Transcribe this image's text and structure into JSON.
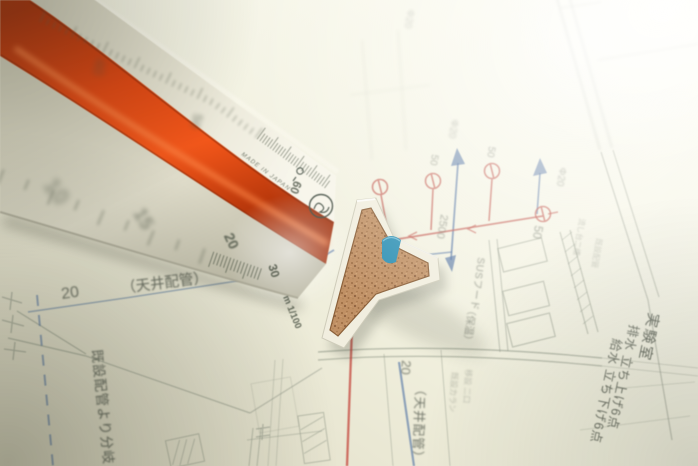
{
  "ruler": {
    "made_in_label": "MADE IN JAPAN",
    "scale_label": "m 1/100",
    "near_face_numbers": [
      "10",
      "15",
      "20",
      "30"
    ],
    "top_face_numbers": [
      "40",
      "50",
      "60"
    ]
  },
  "drawing": {
    "labels": [
      {
        "id": "dim-20-left",
        "text": "20"
      },
      {
        "id": "ceiling-pipe-h",
        "text": "（天井配管）"
      },
      {
        "id": "branch-note",
        "text": "既設配管より分岐"
      },
      {
        "id": "room-lab",
        "text": "実験室"
      },
      {
        "id": "drain-note",
        "text": "排水 立ち上げ6点"
      },
      {
        "id": "supply-note",
        "text": "給水 立ち下げ6点"
      },
      {
        "id": "ceiling-pipe-v",
        "text": "（天井配管）"
      },
      {
        "id": "small-note-1",
        "text": "既設カラン"
      },
      {
        "id": "small-note-2",
        "text": "移設 二口"
      },
      {
        "id": "sus-hood",
        "text": "SUSフード"
      },
      {
        "id": "hood-sub",
        "text": "（保温）"
      },
      {
        "id": "dim-2500",
        "text": "2500"
      },
      {
        "id": "dim-50-a",
        "text": "50"
      },
      {
        "id": "dim-50-b",
        "text": "50"
      },
      {
        "id": "dim-50-c",
        "text": "50"
      },
      {
        "id": "dia-20-a",
        "text": "Φ20"
      },
      {
        "id": "dia-20-b",
        "text": "Φ20"
      },
      {
        "id": "dia-20-c",
        "text": "Φ20"
      },
      {
        "id": "dim-20-bottom",
        "text": "20"
      },
      {
        "id": "tiny-note-1",
        "text": "流し台二槽"
      },
      {
        "id": "tiny-note-2",
        "text": "既設配管"
      }
    ]
  },
  "colors": {
    "paper_base": "#efeedb",
    "paper_bright": "#fdfdf6",
    "ruler_face": "#dedbc8",
    "stripe_red": "#d23a0a",
    "stripe_highlight": "#ff8a4a",
    "pipe_red": "#c05048",
    "pipe_blue": "#4d6fa3",
    "line_gray": "#8b9384",
    "text_gray": "#555b50",
    "wedge_blue": "#2b8fb4",
    "cork": "#c09064",
    "cap_white": "#f1eedf"
  }
}
